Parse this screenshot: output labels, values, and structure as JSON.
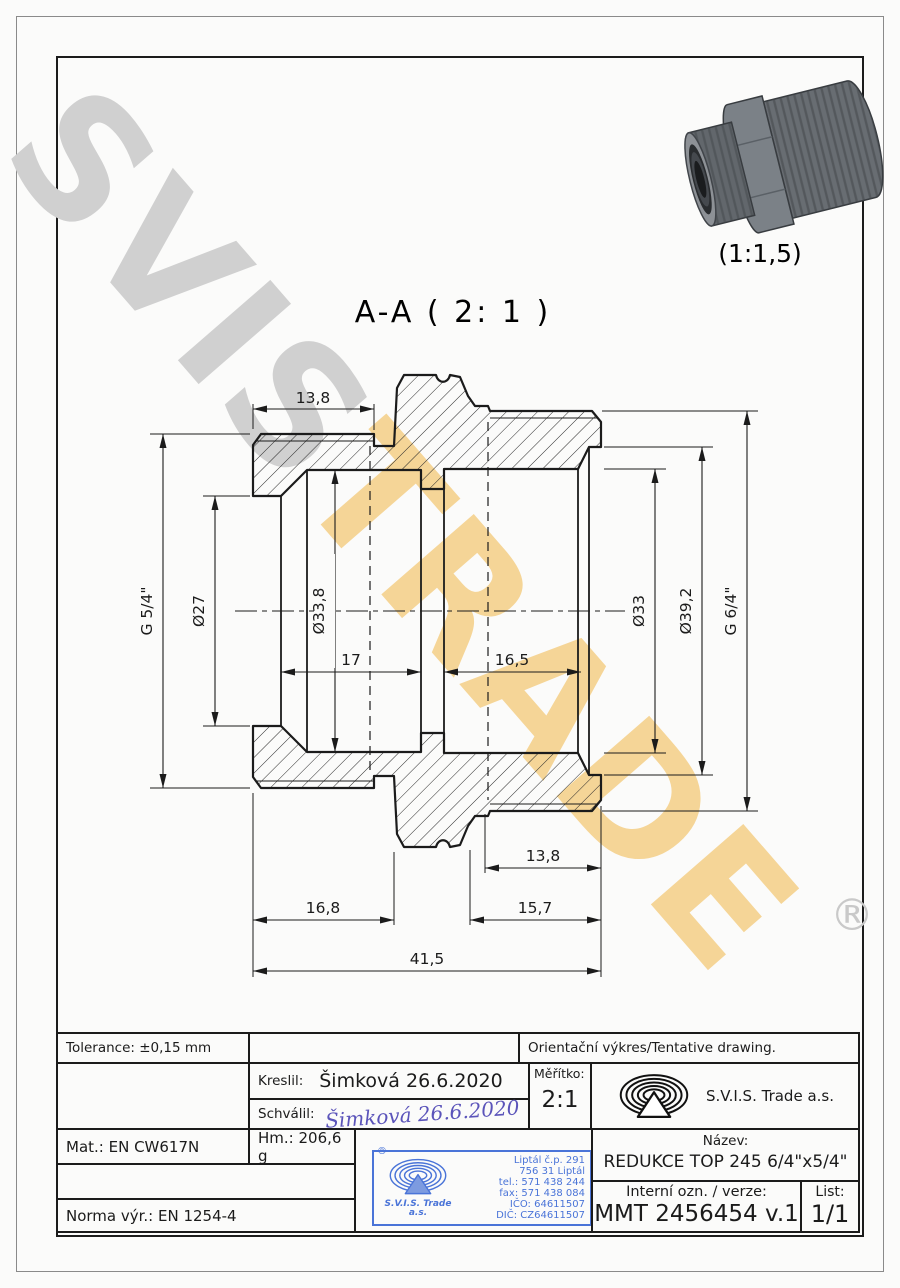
{
  "watermark": {
    "part1": "SVIS",
    "part2": "TRADE",
    "registered": "®",
    "gray": "#d0d0d0",
    "gold": "#f5d28f"
  },
  "view": {
    "section_label": "A-A ( 2: 1 )",
    "thumb_scale_label": "(1:1,5)"
  },
  "dimensions": {
    "top_length": "13,8",
    "left_thread": "G 5/4\"",
    "bore_small": "Ø27",
    "bore_left": "Ø33,8",
    "depth_left": "17",
    "depth_right": "16,5",
    "bore_right": "Ø33",
    "bore_mouth": "Ø39,2",
    "right_thread": "G 6/4\"",
    "thread_length_bottom": "13,8",
    "bottom_left_length": "16,8",
    "bottom_right_length": "15,7",
    "total_length": "41,5"
  },
  "title_block": {
    "tolerance": "Tolerance: ±0,15 mm",
    "note": "Orientační výkres/Tentative drawing.",
    "drawn_label": "Kreslil:",
    "drawn_value": "Šimková 26.6.2020",
    "approved_label": "Schválil:",
    "approved_signature": "Šimková 26.6.2020",
    "scale_label": "Měřítko:",
    "scale_value": "2:1",
    "company": "S.V.I.S. Trade a.s.",
    "material": "Mat.: EN CW617N",
    "weight": "Hm.: 206,6 g",
    "norm": "Norma výr.: EN 1254-4",
    "name_label": "Název:",
    "name_value": "REDUKCE TOP 245 6/4\"x5/4\"",
    "internal_label": "Interní ozn. / verze:",
    "internal_value": "MMT 2456454 v.1",
    "sheet_label": "List:",
    "sheet_value": "1/1"
  },
  "stamp": {
    "registered": "®",
    "company": "S.V.I.S. Trade",
    "company2": "a.s.",
    "lines": [
      "Liptál č.p. 291",
      "756 31 Liptál",
      "tel.: 571 438 244",
      "fax: 571 438 084",
      "IČO: 64611507",
      "DIČ: CZ64611507"
    ],
    "blue": "#4a74d8"
  }
}
